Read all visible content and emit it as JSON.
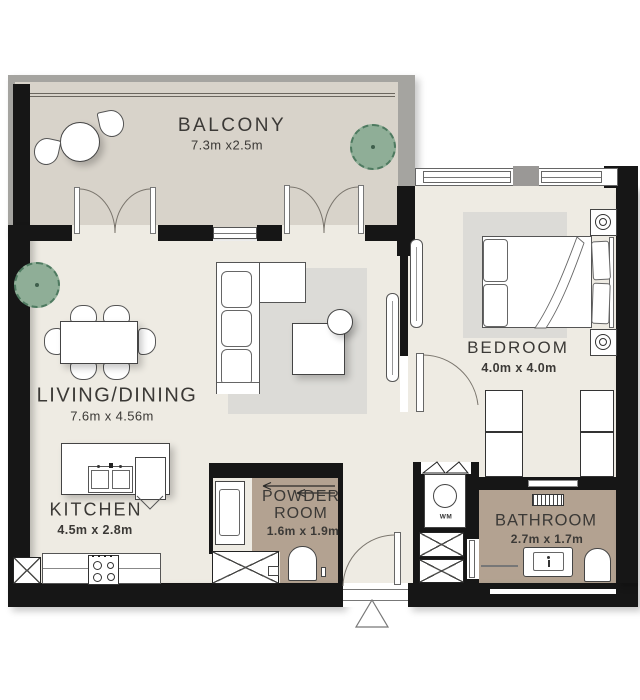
{
  "rooms": {
    "balcony": {
      "name": "BALCONY",
      "dims": "7.3m x2.5m"
    },
    "living_dining": {
      "name": "LIVING/DINING",
      "dims": "7.6m x 4.56m"
    },
    "bedroom": {
      "name": "BEDROOM",
      "dims": "4.0m x 4.0m"
    },
    "kitchen": {
      "name": "KITCHEN",
      "dims": "4.5m x 2.8m"
    },
    "powder_room": {
      "name_line1": "POWDER",
      "name_line2": "ROOM",
      "dims": "1.6m x 1.9m"
    },
    "bathroom": {
      "name": "BATHROOM",
      "dims": "2.7m x 1.7m"
    }
  },
  "fixtures": {
    "washer_label": "WM"
  },
  "colors": {
    "wall": "#161616",
    "room_floor": "#eeebe3",
    "balcony_floor": "#d8d3ca",
    "wet_room_floor": "#b3a291",
    "rug": "#dcdbd7",
    "railing": "#a5a4a0",
    "plant": "#8fae97",
    "text": "#3b3936"
  }
}
